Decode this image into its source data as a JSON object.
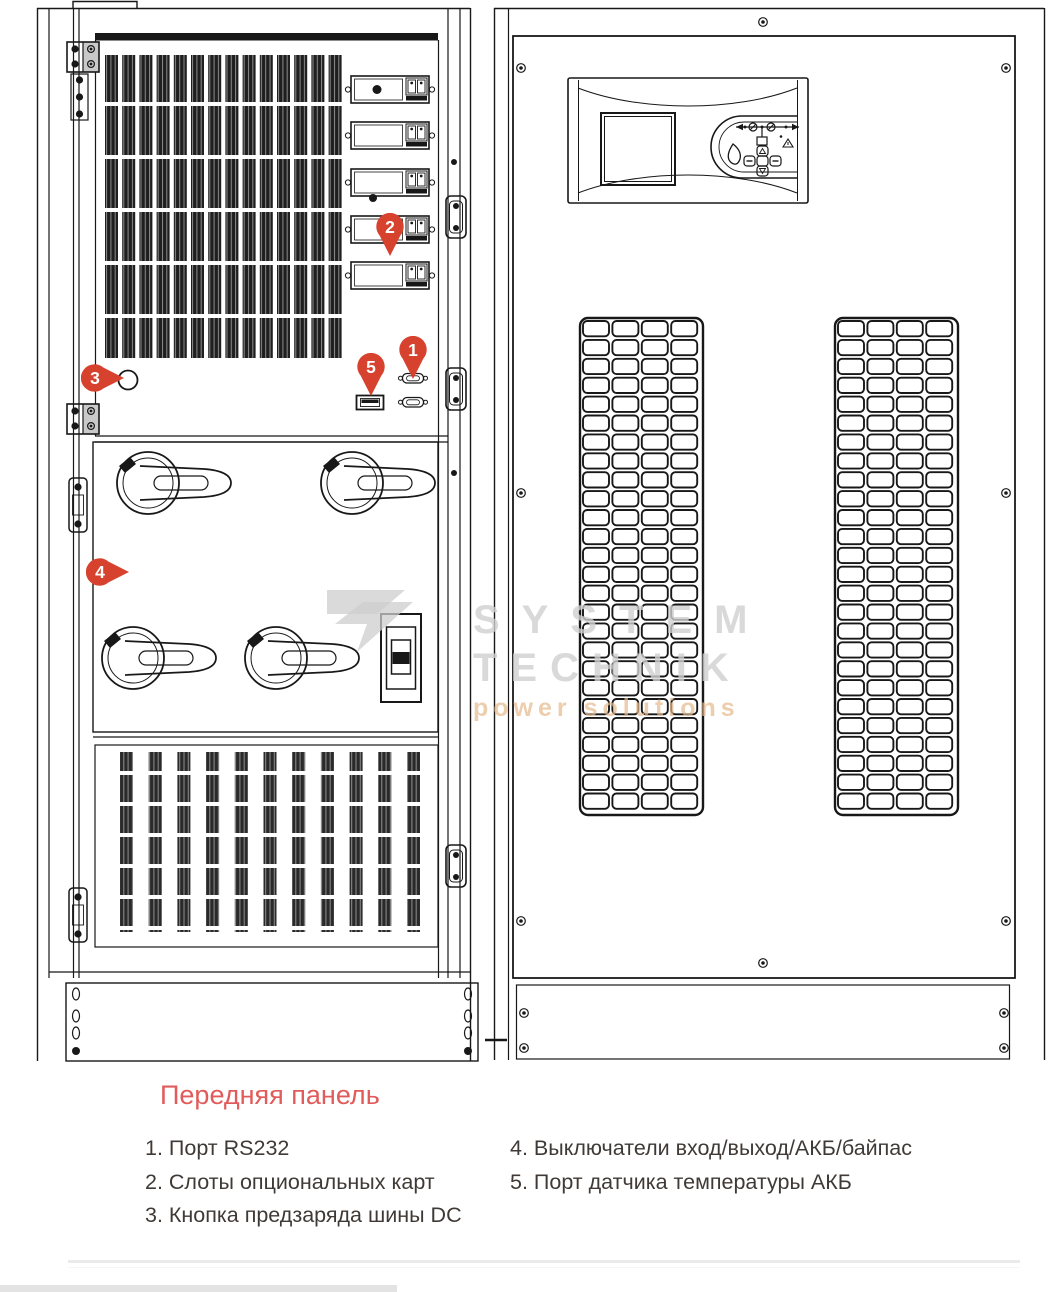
{
  "title": {
    "text": "Передняя панель",
    "color": "#e25b5b"
  },
  "legend": {
    "col1": [
      "1. Порт RS232",
      "2. Слоты опциональных карт",
      "3. Кнопка предзаряда шины DC"
    ],
    "col2": [
      "4. Выключатели вход/выход/АКБ/байпас",
      "5. Порт датчика температуры АКБ"
    ]
  },
  "markers": {
    "color": "#d7422e",
    "items": [
      {
        "label": "1",
        "dir": "down",
        "cx": 413,
        "cy": 350
      },
      {
        "label": "2",
        "dir": "down",
        "cx": 390,
        "cy": 227
      },
      {
        "label": "3",
        "dir": "right",
        "cx": 95,
        "cy": 378
      },
      {
        "label": "4",
        "dir": "right",
        "cx": 100,
        "cy": 572
      },
      {
        "label": "5",
        "dir": "down",
        "cx": 371,
        "cy": 367
      }
    ]
  },
  "watermark": {
    "line1": "SYSTEM",
    "line2": "TECHNIK",
    "line3": "power solutions"
  }
}
